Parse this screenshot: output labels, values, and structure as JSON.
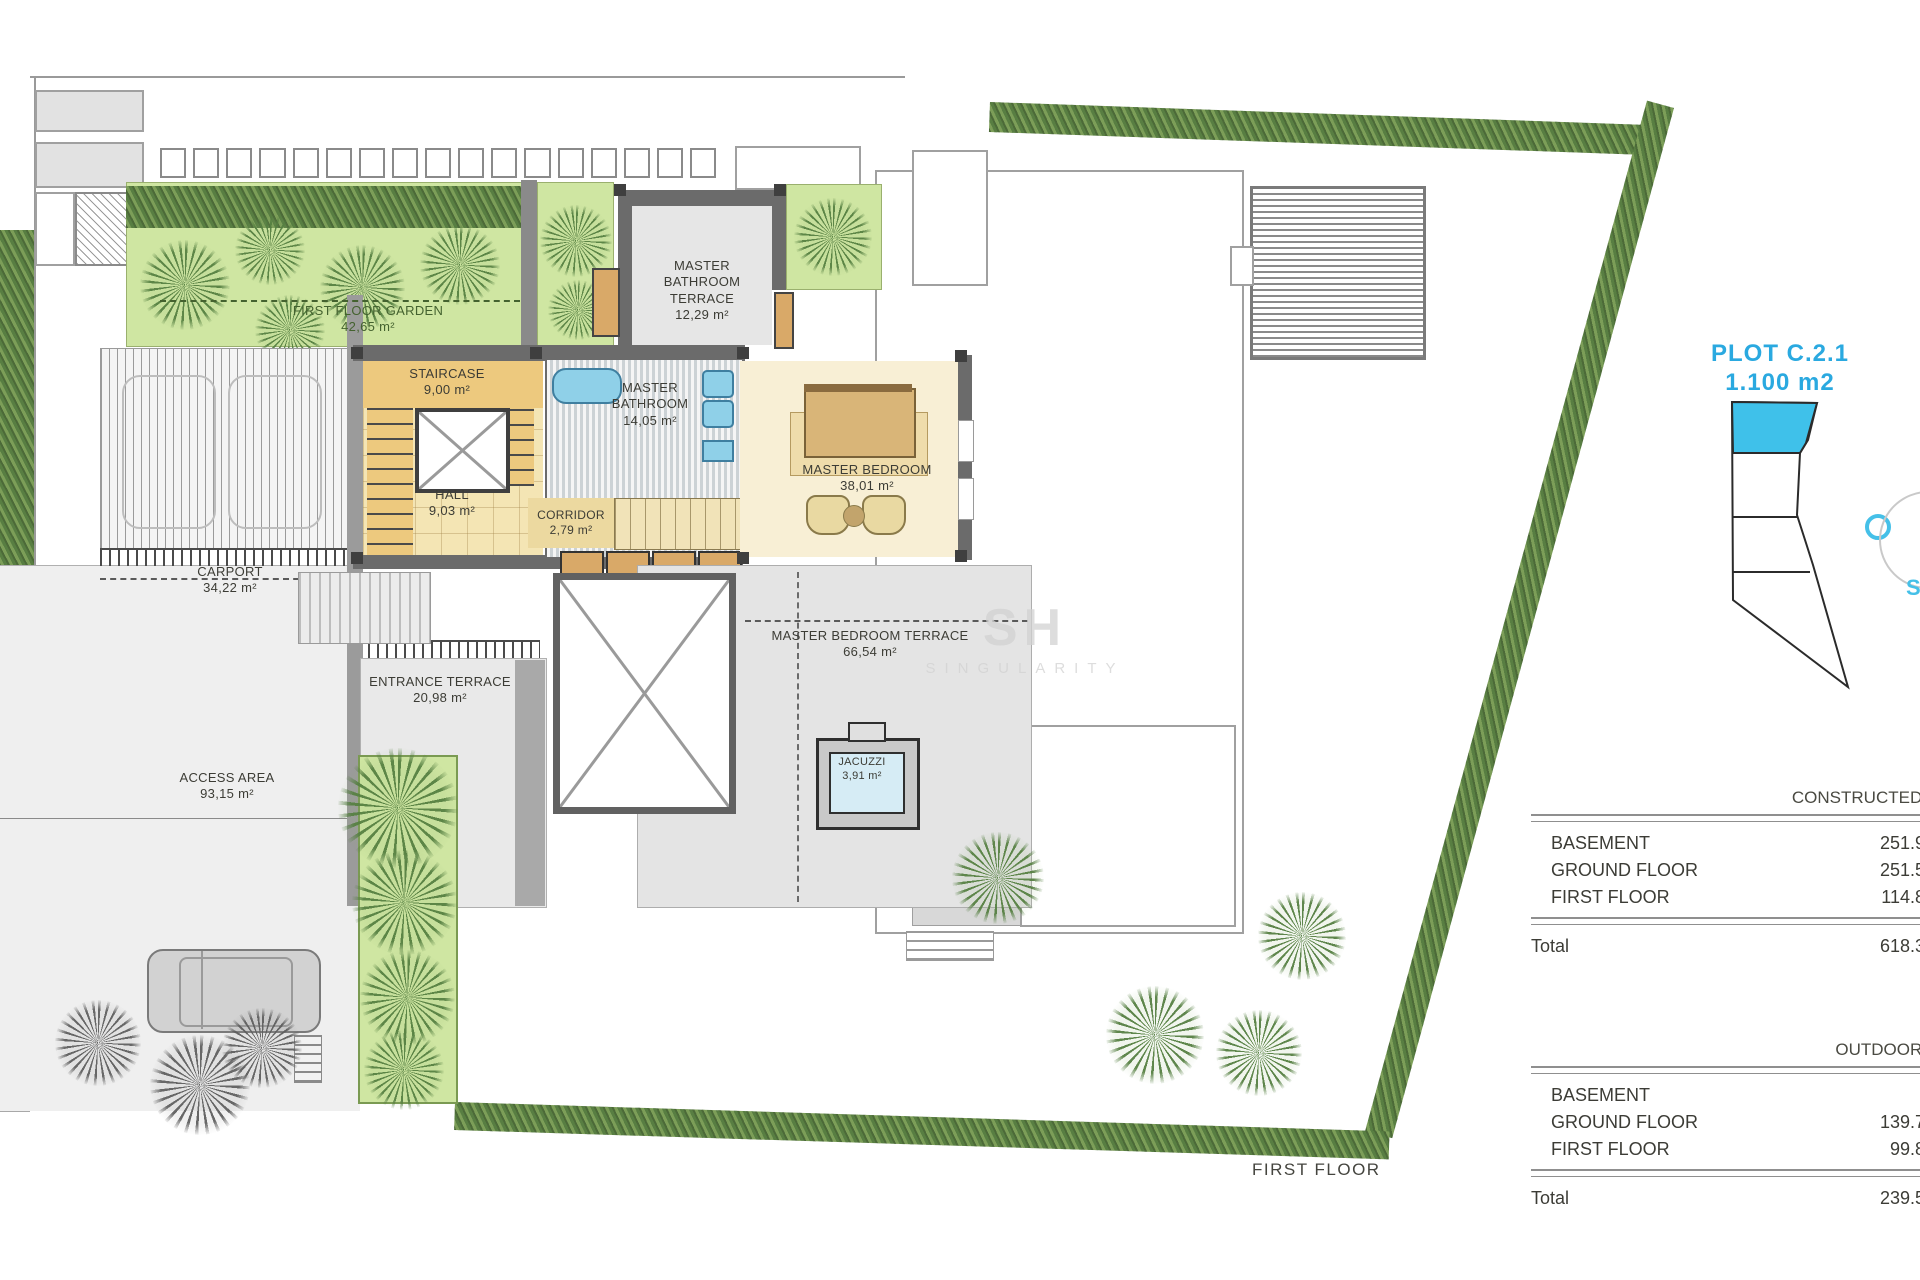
{
  "plan": {
    "caption": "FIRST FLOOR",
    "watermark_initials": "SH",
    "watermark_name": "SINGULARITY",
    "rooms": [
      {
        "name": "FIRST FLOOR GARDEN",
        "area": "42,65 m²"
      },
      {
        "name": "MASTER BATHROOM TERRACE",
        "area": "12,29 m²"
      },
      {
        "name": "STAIRCASE",
        "area": "9,00 m²"
      },
      {
        "name": "MASTER BATHROOM",
        "area": "14,05 m²"
      },
      {
        "name": "MASTER BEDROOM",
        "area": "38,01 m²"
      },
      {
        "name": "HALL",
        "area": "9,03 m²"
      },
      {
        "name": "CORRIDOR",
        "area": "2,79 m²"
      },
      {
        "name": "CARPORT",
        "area": "34,22 m²"
      },
      {
        "name": "ENTRANCE TERRACE",
        "area": "20,98 m²"
      },
      {
        "name": "MASTER BEDROOM TERRACE",
        "area": "66,54 m²"
      },
      {
        "name": "ACCESS AREA",
        "area": "93,15 m²"
      },
      {
        "name": "JACUZZI",
        "area": "3,91 m²"
      }
    ]
  },
  "side_panel": {
    "plot": {
      "title": "PLOT C.2.1",
      "area": "1.100 m2",
      "s_label": "S"
    },
    "constructed": {
      "title": "CONSTRUCTED area",
      "rows": [
        {
          "label": "BASEMENT",
          "value": "251.95 m²"
        },
        {
          "label": "GROUND FLOOR",
          "value": "251.55 m²"
        },
        {
          "label": "FIRST FLOOR",
          "value": "114.80 m²"
        }
      ],
      "total_label": "Total",
      "total_value": "618.38 m²"
    },
    "outdoor": {
      "title": "OUTDOOR area",
      "rows": [
        {
          "label": "BASEMENT",
          "value": ""
        },
        {
          "label": "GROUND FLOOR",
          "value": "139.70 m²"
        },
        {
          "label": "FIRST FLOOR",
          "value": "99.81 m²"
        }
      ],
      "total_label": "Total",
      "total_value": "239.51 m²"
    }
  },
  "colors": {
    "accent_blue": "#29a9e0",
    "plot_cyan": "#3fc1ea",
    "garden_green": "#cfe6a2",
    "hedge_green": "#5a7d42",
    "wall_gray": "#6b6b6b",
    "floor_tan": "#f2e0ac",
    "terrace_gray": "#e4e4e4"
  }
}
